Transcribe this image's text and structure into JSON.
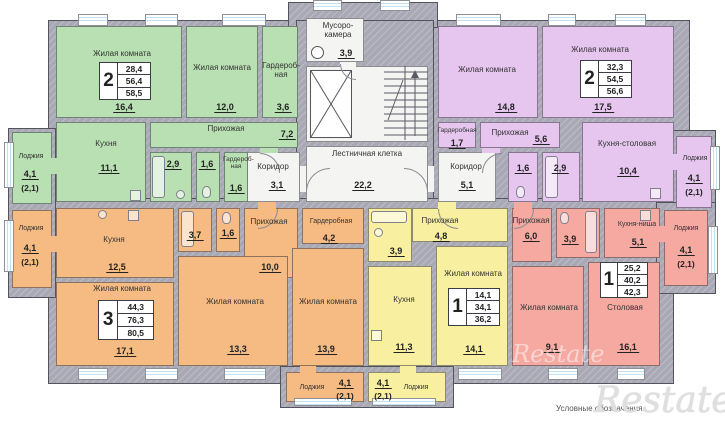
{
  "legend": {
    "caption": "Условные обозначения",
    "brand": "Restate"
  },
  "colors": {
    "green": "#b9e0b2",
    "purple": "#e6c6ef",
    "orange": "#f6bb82",
    "yellow": "#f8f0a0",
    "pink": "#f5a9a1",
    "wall": "#a9a9b6",
    "corridor": "#f4f4f2",
    "glass": "#bfe2f1"
  },
  "common": {
    "trash": {
      "name": "Мусоро-камера",
      "area": "3,9"
    },
    "stairs": {
      "name": "Лестничная клетка",
      "area": "22,2"
    },
    "corridor_left": {
      "name": "Коридор",
      "area": "3,1"
    },
    "corridor_right": {
      "name": "Коридор",
      "area": "5,1"
    }
  },
  "apts": {
    "green": {
      "badge": {
        "num": "2",
        "living": "28,4",
        "area": "56,4",
        "total": "58,5"
      },
      "living1": {
        "name": "Жилая комната",
        "area": "16,4"
      },
      "living2": {
        "name": "Жилая комната",
        "area": "12,0"
      },
      "wardrobe1": {
        "name": "Гардероб-ная",
        "area": "3,6"
      },
      "hall": {
        "name": "Прихожая",
        "area": "7,2"
      },
      "kitchen": {
        "name": "Кухня",
        "area": "11,1"
      },
      "bath": {
        "area": "2,9"
      },
      "wc": {
        "area": "1,6"
      },
      "wardrobe2": {
        "name": "Гардероб-ная",
        "area": "1,6"
      },
      "loggia": {
        "name": "Лоджия",
        "area": "4,1",
        "coef": "(2,1)"
      }
    },
    "purple": {
      "badge": {
        "num": "2",
        "living": "32,3",
        "area": "54,5",
        "total": "56,6"
      },
      "living1": {
        "name": "Жилая комната",
        "area": "14,8"
      },
      "living2": {
        "name": "Жилая комната",
        "area": "17,5"
      },
      "wardrobe": {
        "name": "Гардеробная",
        "area": "1,7"
      },
      "hall": {
        "name": "Прихожая",
        "area": "5,6"
      },
      "wc": {
        "area": "1,6"
      },
      "bath": {
        "area": "2,9"
      },
      "kitchen": {
        "name": "Кухня-столовая",
        "area": "10,4"
      },
      "loggia": {
        "name": "Лоджия",
        "area": "4,1",
        "coef": "(2,1)"
      }
    },
    "orange": {
      "badge": {
        "num": "3",
        "living": "44,3",
        "area": "76,3",
        "total": "80,5"
      },
      "kitchen": {
        "name": "Кухня",
        "area": "12,5"
      },
      "bath": {
        "area": "3,7"
      },
      "wc": {
        "area": "1,6"
      },
      "hall": {
        "name": "Прихожая",
        "area": "10,0"
      },
      "wardrobe": {
        "name": "Гардеробная",
        "area": "4,2"
      },
      "living1": {
        "name": "Жилая комната",
        "area": "17,1"
      },
      "living2": {
        "name": "Жилая комната",
        "area": "13,3"
      },
      "living3": {
        "name": "Жилая комната",
        "area": "13,9"
      },
      "loggia_left": {
        "name": "Лоджия",
        "area": "4,1",
        "coef": "(2,1)"
      },
      "loggia_bottom": {
        "name": "Лоджия",
        "area": "4,1",
        "coef": "(2,1)"
      }
    },
    "yellow": {
      "badge": {
        "num": "1",
        "living": "14,1",
        "area": "34,1",
        "total": "36,2"
      },
      "hall": {
        "name": "Прихожая",
        "area": "4,8"
      },
      "bath": {
        "area": "3,9"
      },
      "kitchen": {
        "name": "Кухня",
        "area": "11,3"
      },
      "living": {
        "name": "Жилая комната",
        "area": "14,1"
      },
      "loggia": {
        "name": "Лоджия",
        "area": "4,1",
        "coef": "(2,1)"
      }
    },
    "pink": {
      "badge": {
        "num": "1",
        "living": "25,2",
        "area": "40,2",
        "total": "42,3"
      },
      "hall": {
        "name": "Прихожая",
        "area": "6,0"
      },
      "bath": {
        "area": "3,9"
      },
      "kitchen": {
        "name": "Кухня-ниша",
        "area": "5,1"
      },
      "living": {
        "name": "Жилая комната",
        "area": "9,1"
      },
      "dining": {
        "name": "Столовая",
        "area": "16,1"
      },
      "loggia": {
        "name": "Лоджия",
        "area": "4,1",
        "coef": "(2,1)"
      }
    }
  }
}
